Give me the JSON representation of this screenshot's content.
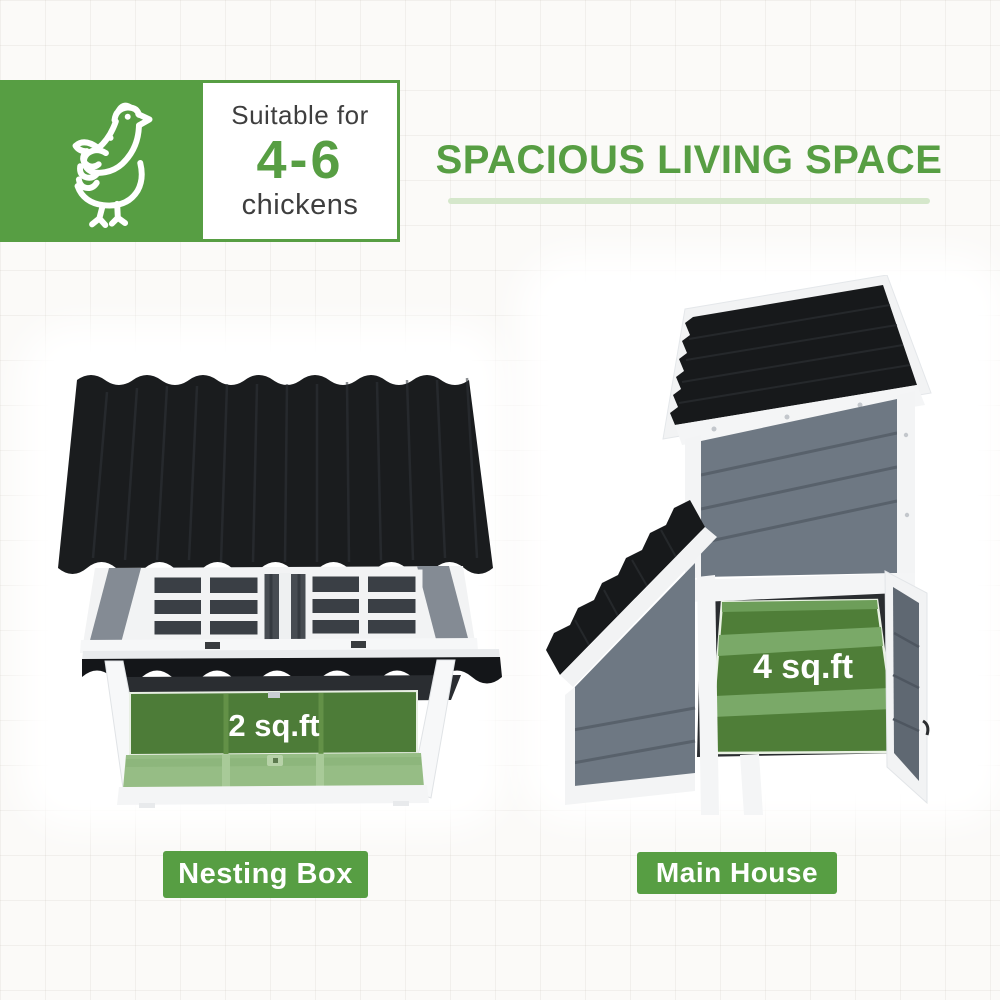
{
  "header": {
    "title": "SPACIOUS LIVING SPACE"
  },
  "capacity_badge": {
    "icon": "chicken-icon",
    "prefix": "Suitable for",
    "range": "4-6",
    "suffix": "chickens"
  },
  "figures": {
    "left": {
      "caption": "Nesting Box",
      "area_label": "2 sq.ft"
    },
    "right": {
      "caption": "Main House",
      "area_label": "4 sq.ft"
    }
  },
  "colors": {
    "brand_green": "#579e43",
    "underline_green": "#d5e7cb",
    "floor_green_dark": "#4d7c38",
    "floor_green_light": "#96bd85",
    "step_green": "#7aa968",
    "roof_black": "#17191b",
    "wood_gray": "#6e7883",
    "text_dark": "#3e3e3e",
    "label_text": "#ffffff"
  }
}
